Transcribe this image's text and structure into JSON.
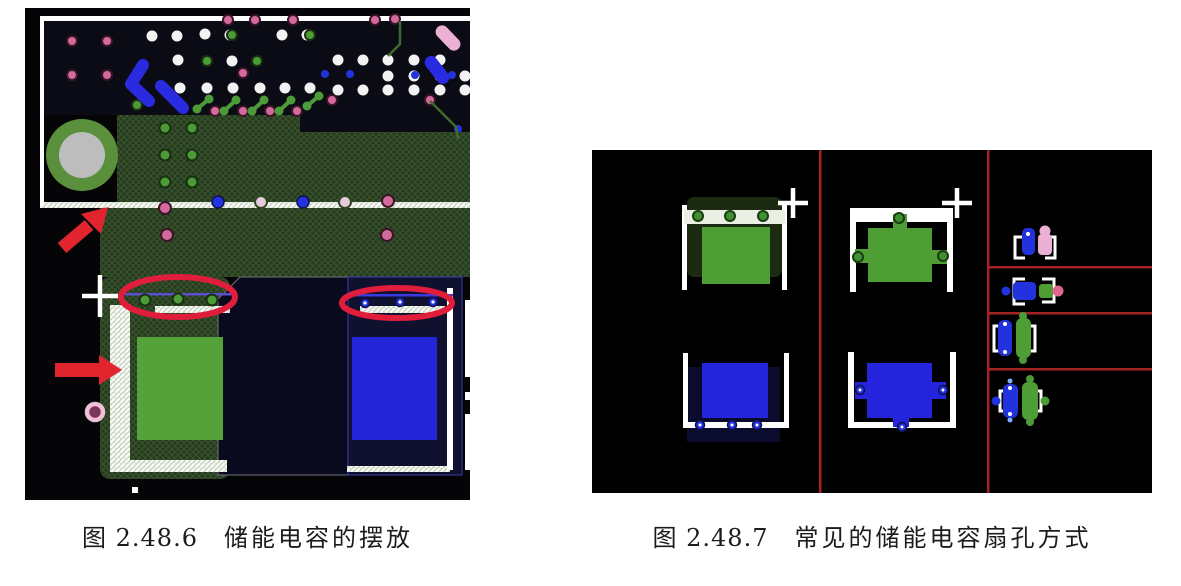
{
  "page": {
    "background_color": "#ffffff"
  },
  "figures": {
    "left": {
      "caption": {
        "label": "图 2.48.6",
        "title": "储能电容的摆放"
      },
      "annotations": [
        "red-arrow-up-right-icon",
        "red-arrow-right-icon",
        "highlight-ellipse-green-vias",
        "highlight-ellipse-blue-vias",
        "crosshair-marker-icon"
      ],
      "content": "pcb-layout-screenshot"
    },
    "right": {
      "caption": {
        "label": "图 2.48.7",
        "title": "常见的储能电容扇孔方式"
      },
      "grid": {
        "columns": 3,
        "right_column_rows": 4
      },
      "content": "capacitor-fanout-patterns"
    }
  },
  "colors": {
    "annotation_red": "#e2242e",
    "highlight_red": "#e11d3c",
    "capacitor_green": "#55a23a",
    "capacitor_blue": "#2525d8",
    "fanout_green": "#4f9e35",
    "fanout_blue": "#2424dc",
    "divider_red": "#a42222",
    "silkscreen_white": "#ffffff",
    "copper_pour_green": "#263a1e",
    "board_black": "#050507",
    "via_pink": "#d4699e",
    "via_blue": "#2233dd",
    "via_green": "#4c9a38",
    "via_white": "#f2f2f2",
    "pad_pink": "#ecb0d4",
    "pad_gray": "#bdbdbd"
  }
}
